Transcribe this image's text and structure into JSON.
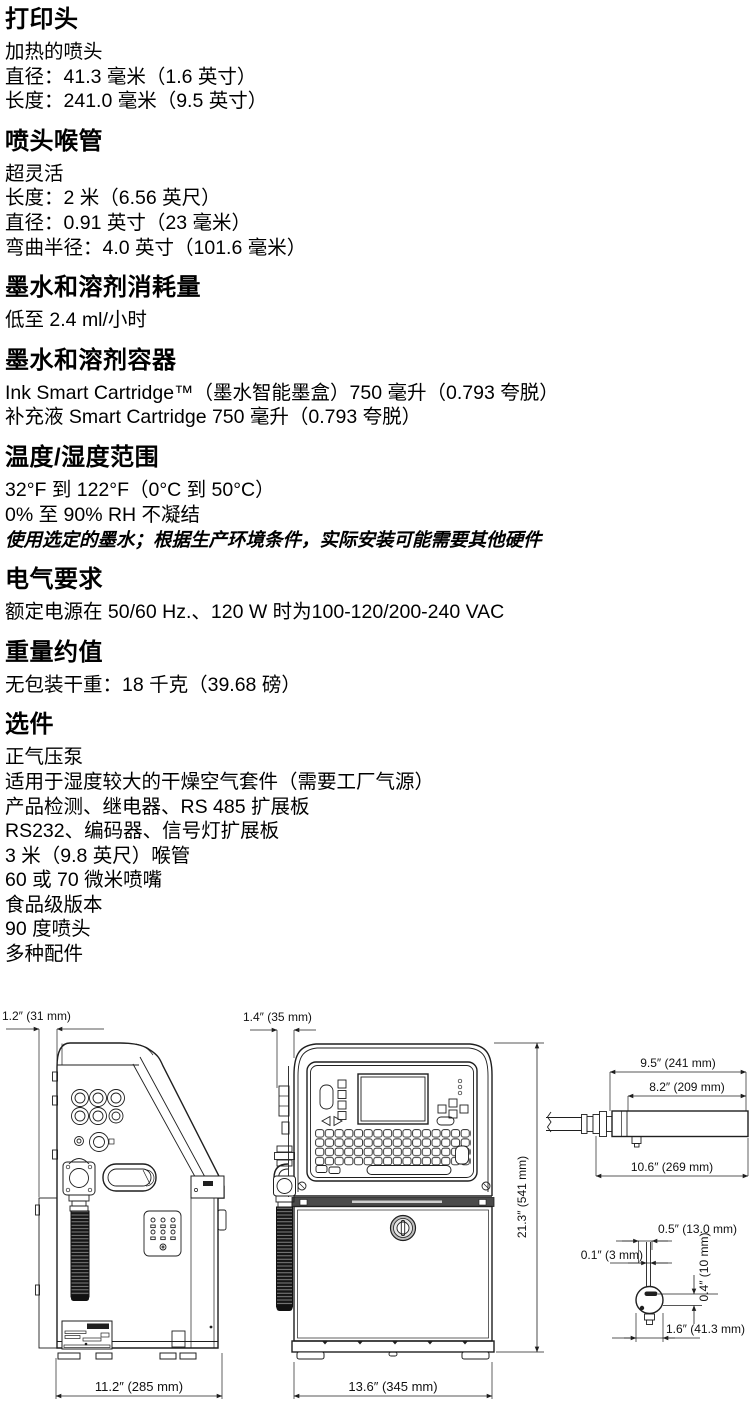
{
  "document": {
    "ink_color": "#1f1f1f",
    "paper_color": "#ffffff",
    "sections": [
      {
        "heading": "打印头",
        "lines": [
          "加热的喷头",
          "直径：41.3 毫米（1.6 英寸）",
          "长度：241.0 毫米（9.5 英寸）"
        ]
      },
      {
        "heading": "喷头喉管",
        "lines": [
          "超灵活",
          "长度：2 米（6.56 英尺）",
          "直径：0.91 英寸（23 毫米）",
          "弯曲半径：4.0 英寸（101.6 毫米）"
        ]
      },
      {
        "heading": "墨水和溶剂消耗量",
        "lines": [
          "低至 2.4 ml/小时"
        ]
      },
      {
        "heading": "墨水和溶剂容器",
        "lines": [
          "Ink Smart Cartridge™（墨水智能墨盒）750 毫升（0.793 夸脱）",
          "补充液 Smart Cartridge 750 毫升（0.793 夸脱）"
        ]
      },
      {
        "heading": "温度/湿度范围",
        "lines": [
          "32°F 到 122°F（0°C 到 50°C）",
          "0% 至 90% RH 不凝结"
        ],
        "note": "使用选定的墨水；根据生产环境条件，实际安装可能需要其他硬件"
      },
      {
        "heading": "电气要求",
        "lines": [
          "额定电源在 50/60 Hz.、120 W 时为100-120/200-240 VAC"
        ]
      },
      {
        "heading": "重量约值",
        "lines": [
          "无包装干重：18 千克（39.68 磅）"
        ]
      },
      {
        "heading": "选件",
        "lines": [
          "正气压泵",
          "适用于湿度较大的干燥空气套件（需要工厂气源）",
          "产品检测、继电器、RS 485 扩展板",
          "RS232、编码器、信号灯扩展板",
          "3 米（9.8 英尺）喉管",
          "60 或 70 微米喷嘴",
          "食品级版本",
          "90 度喷头",
          "多种配件"
        ]
      }
    ]
  },
  "drawings": {
    "side_view": {
      "dims": {
        "top_depth": "1.2″ (31 mm)",
        "bottom_width": "11.2″ (285 mm)"
      }
    },
    "front_view": {
      "dims": {
        "top_depth": "1.4″ (35 mm)",
        "height": "21.3″ (541 mm)",
        "bottom_width": "13.6″ (345 mm)"
      }
    },
    "printhead_side_view": {
      "dims": {
        "body_length": "9.5″ (241 mm)",
        "cover_length": "8.2″ (209 mm)",
        "overall_length": "10.6″ (269 mm)"
      }
    },
    "printhead_end_view": {
      "dims": {
        "slot_offset": "0.5″ (13.0 mm)",
        "tube_width": "0.1″ (3 mm)",
        "vertical_offset": "0.4″ (10 mm)",
        "diameter": "1.6″ (41.3 mm)"
      }
    }
  }
}
